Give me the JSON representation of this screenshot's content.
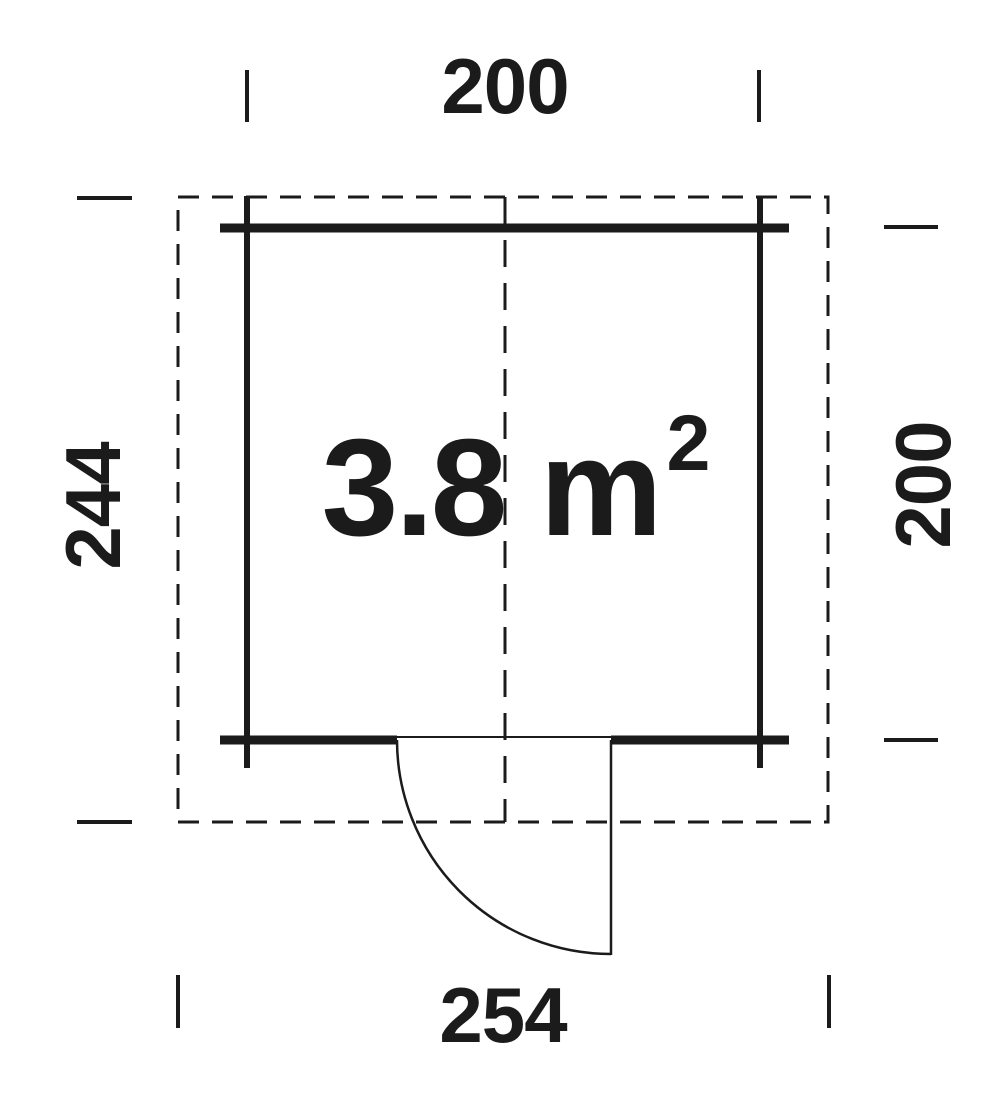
{
  "plan": {
    "type": "floor-plan",
    "area": {
      "text": "3.8 m",
      "sup": "2"
    },
    "dimensions": {
      "top": {
        "label": "200"
      },
      "left": {
        "label": "244"
      },
      "right": {
        "label": "200"
      },
      "bottom": {
        "label": "254"
      }
    },
    "colors": {
      "line": "#1b1b1b",
      "background": "#ffffff"
    }
  }
}
